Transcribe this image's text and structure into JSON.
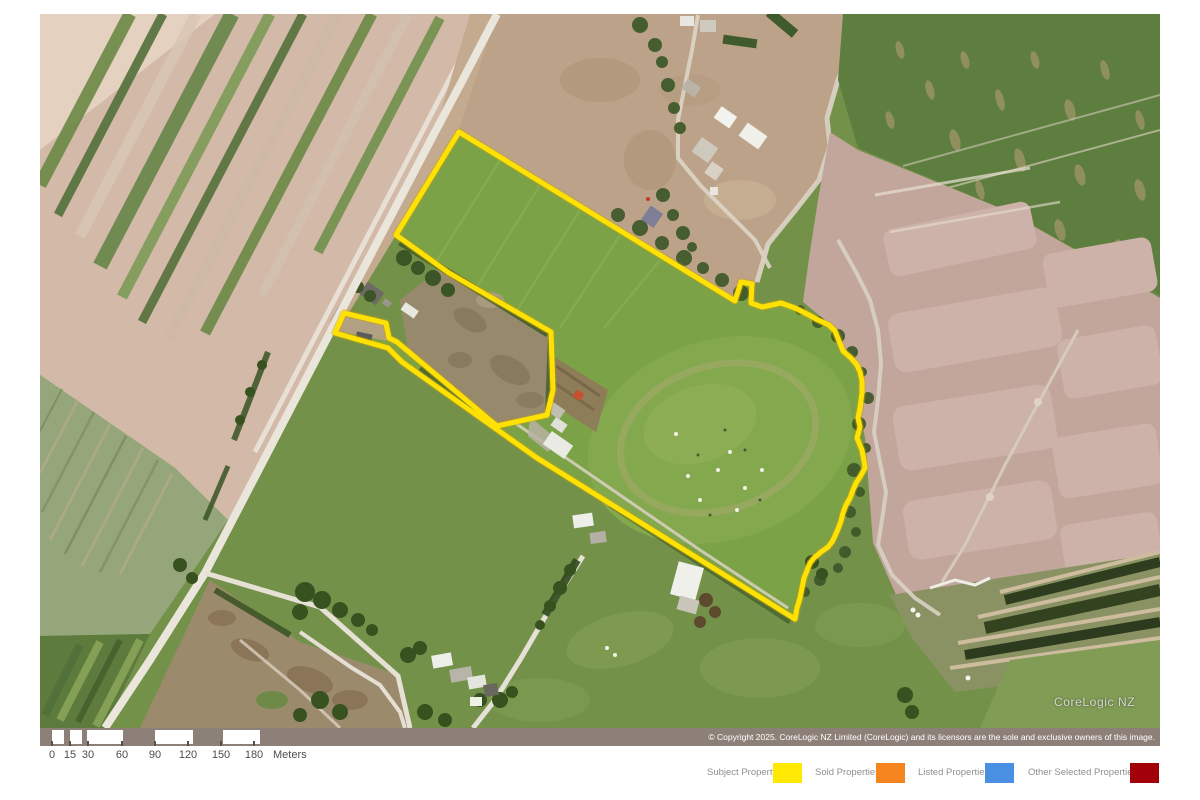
{
  "map": {
    "watermark": "CoreLogic NZ",
    "copyright": "© Copyright 2025. CoreLogic NZ Limited (CoreLogic) and its licensors are the sole and exclusive owners of this image."
  },
  "scalebar": {
    "labels": [
      "0",
      "15",
      "30",
      "60",
      "90",
      "120",
      "150",
      "180"
    ],
    "unit": "Meters"
  },
  "legend": {
    "items": [
      {
        "label": "Subject Property",
        "color": "#FFE903"
      },
      {
        "label": "Sold Properties",
        "color": "#F6851F"
      },
      {
        "label": "Listed Properties",
        "color": "#4A90E2"
      },
      {
        "label": "Other Selected Properties",
        "color": "#A30109"
      }
    ]
  },
  "colors": {
    "subject_boundary": "#FFE204",
    "strip_background": "#8D8078"
  }
}
